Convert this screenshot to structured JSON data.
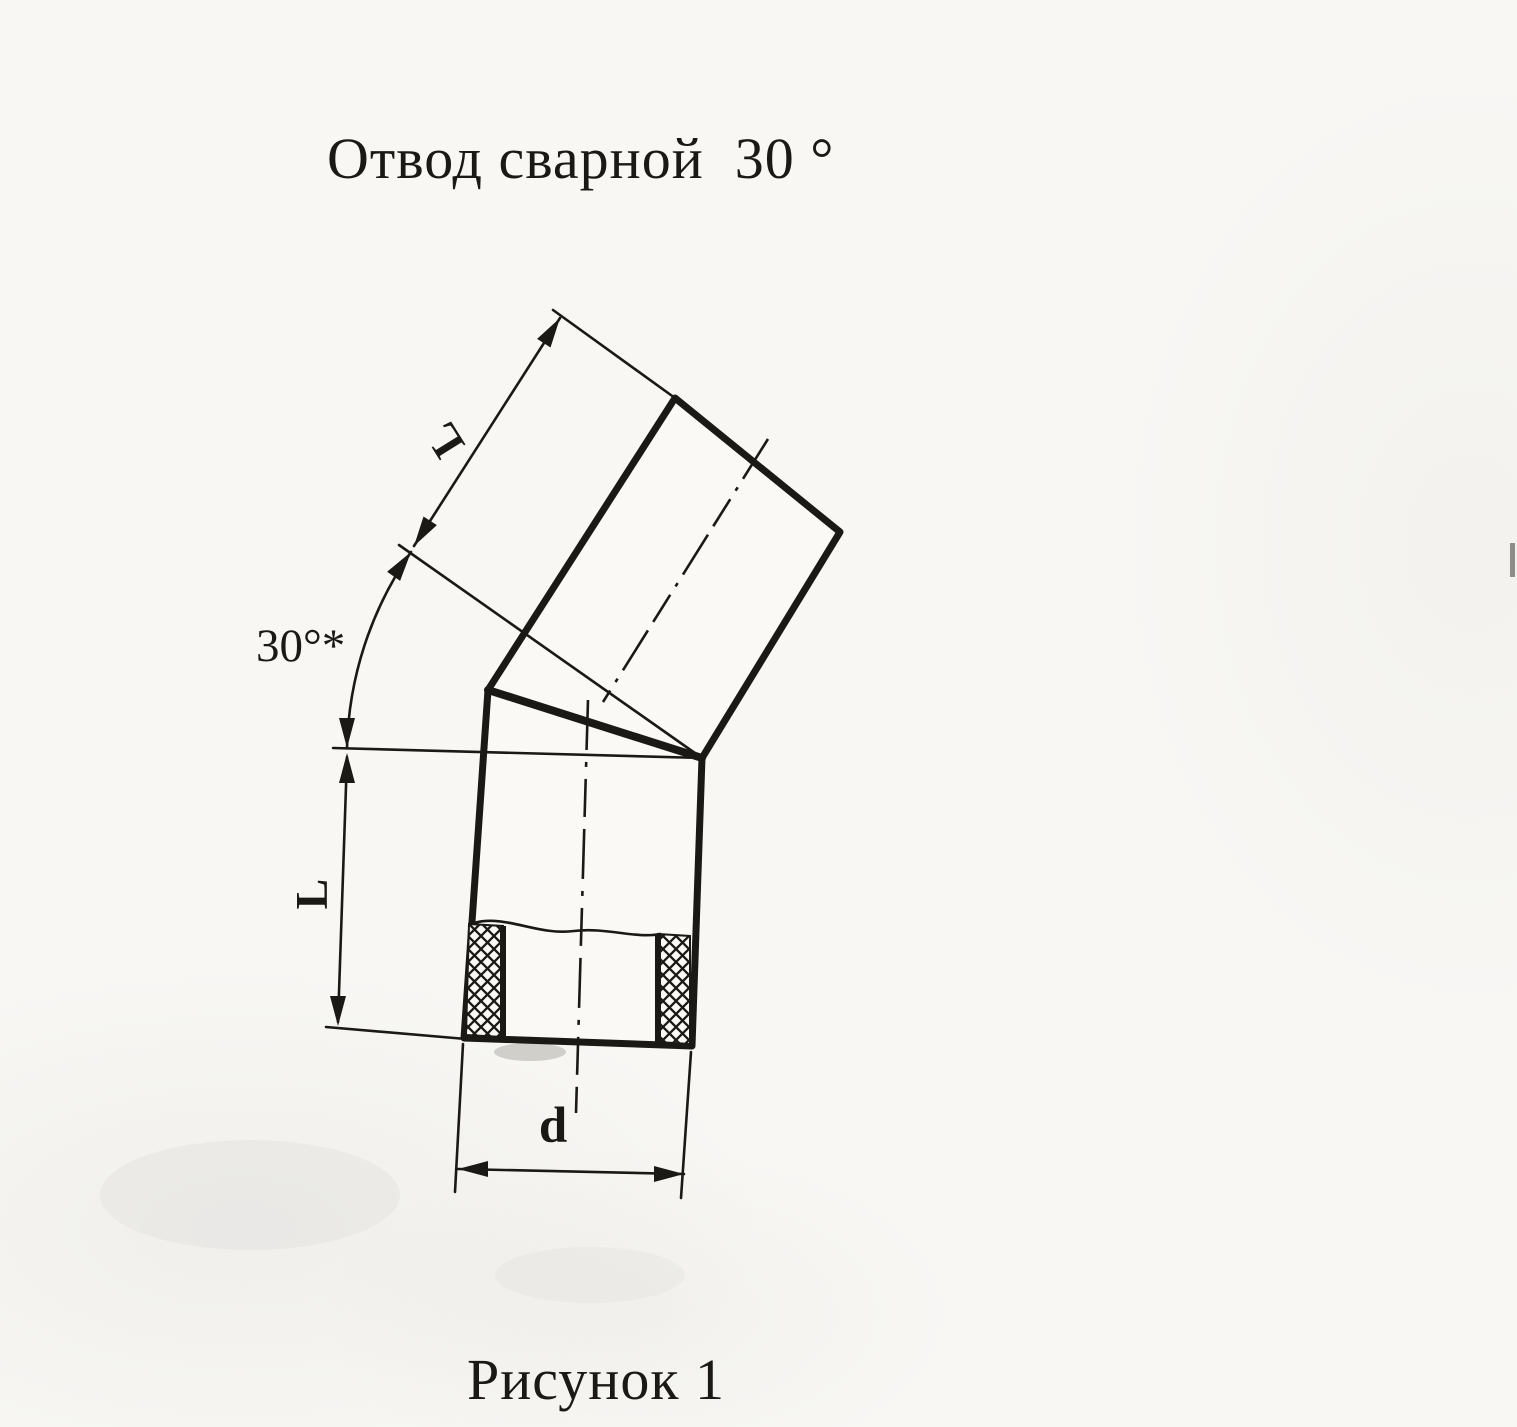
{
  "page": {
    "title": "Отвод сварной  30 °",
    "caption": "Рисунок 1"
  },
  "drawing": {
    "description": "Технический чертёж: отвод сварной из двух сегментов трубы, соединённых под углом 30°, вид сбоку с местным разрезом стенки",
    "labels": {
      "angle": "30°*",
      "upper_segment_length": "L",
      "lower_segment_length": "L",
      "diameter": "d"
    },
    "ink_color": "#1b1916",
    "paper_color": "#f8f7f4"
  }
}
